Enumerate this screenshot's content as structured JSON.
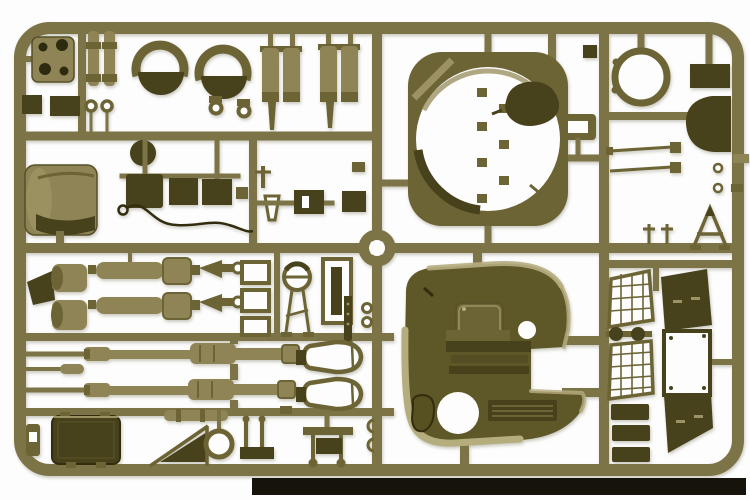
{
  "scene": {
    "subject": "Photograph of an olive-drab injection-molded plastic model kit sprue (parts tree) for an armored vehicle kit, laid on a white background with a dark shadow strip along the bottom edge",
    "content": "Rectangular sprue frame with internal runners holding tank model parts: turret ring, turret shell with hatch openings and vent grille, two gun barrels, recoil cylinders, air-cleaner drums, mantlet drum, hatch rings, D-shaped hatch, stowage box, mesh stowage baskets, fender panels, tow cable and many small fittings",
    "background_note": "no visible text anywhere in the image"
  },
  "palette": {
    "bg": "#fdfdfd",
    "runner": "#7c7346",
    "runnerLight": "#9c9263",
    "runnerDark": "#575028",
    "partLight": "#8e8455",
    "partMid": "#6c6435",
    "partDark": "#47411c",
    "partDarker": "#322d0e",
    "olive": "#5e5728",
    "oliveDeep": "#575020",
    "oliveStep": "#554e24",
    "tan": "#b6ad7f",
    "hole": "#2e2a10",
    "strip": "#16130b",
    "white": "#ffffff"
  },
  "parts": [
    "sprue-frame",
    "runner-grid",
    "hub-ring",
    "mounting-plate",
    "pin-cylinders",
    "clamp-ring-left",
    "clamp-ring-right",
    "bowl-half-left",
    "bowl-half-right",
    "eyelet-fittings",
    "equipment-blocks",
    "dark-disc",
    "air-cleaner-drums-1",
    "air-cleaner-drums-2",
    "turret-ring",
    "ring-fittings",
    "teardrop-hatch",
    "hatch-ring",
    "hatch-lid-plate",
    "d-shaped-hatch",
    "thin-rods",
    "trestle-frame",
    "mantlet-drum",
    "engine-blocks",
    "tow-cable",
    "wedge-bracket",
    "hub-drums",
    "recoil-cylinder-1",
    "recoil-cylinder-2",
    "fork-fittings",
    "frame-brackets",
    "periscope-sight",
    "mg-case",
    "machine-gun",
    "eyelet-rings",
    "turret-shell",
    "turret-hatch-door",
    "commander-hatch-opening",
    "loader-hatch-opening",
    "vent-grille",
    "step-plates",
    "gun-barrel-upper",
    "gun-barrel-lower",
    "stowage-box",
    "gun-cradle-cylinder",
    "traverse-ring",
    "mount-bench-1",
    "mount-bench-2",
    "drop-tank-1",
    "drop-tank-2",
    "mesh-basket-1",
    "mesh-basket-2",
    "roadwheel-axle",
    "track-pads",
    "fender-panel-top",
    "frame-panel",
    "fender-panel-bottom",
    "shadow-strip"
  ]
}
